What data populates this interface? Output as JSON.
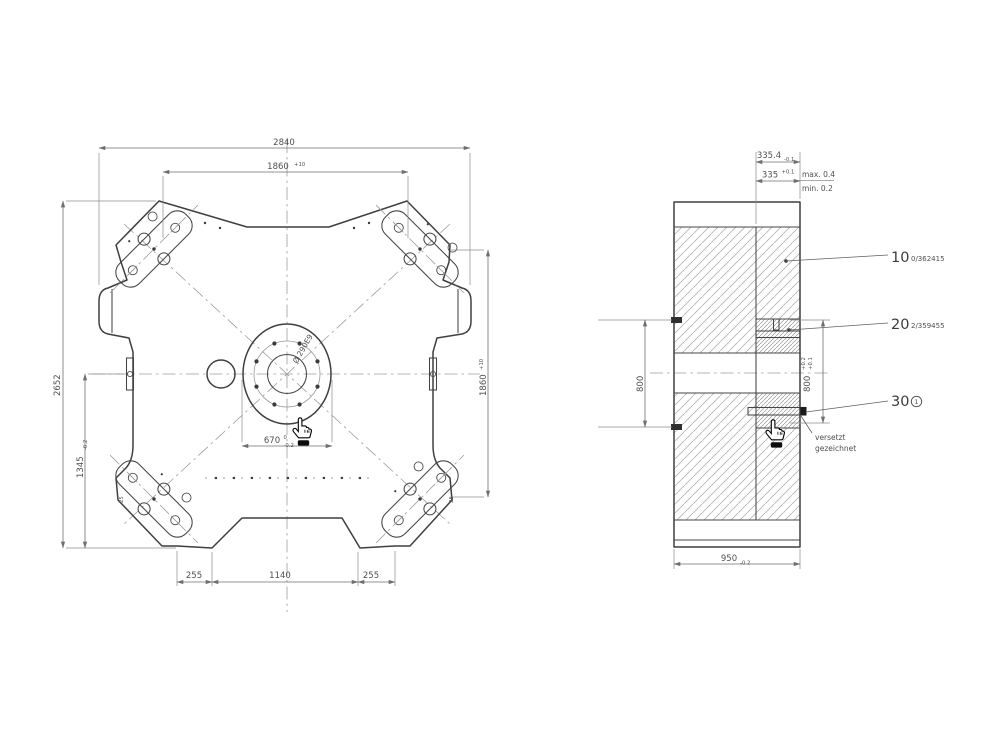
{
  "title": "assembly-drawing",
  "colors": {
    "background": "#ffffff",
    "outline": "#3f3f3f",
    "dimension": "#6f6f6f",
    "hatch": "#b5b5b5",
    "cursor_cuff": "#111111"
  },
  "left_view": {
    "w_total": "2840",
    "w_inner": "1860",
    "w_inner_tol": "+10",
    "h_total": "2652",
    "h_lower": "1345",
    "h_lower_tol": "-0.2",
    "h_right": "1860",
    "h_right_tol": "+10",
    "bore": "Ø 290E9",
    "circle_dia": "670",
    "circle_tol_top": "0",
    "circle_tol_bot": "-0.2",
    "b_left": "255",
    "b_center": "1140",
    "b_right": "255",
    "note_a": "25",
    "note_b": "25"
  },
  "right_view": {
    "step_outer": "335.4",
    "step_outer_tol": "-0.1",
    "step_inner": "335",
    "step_inner_tol": "+0.1",
    "gap_max": "max. 0.4",
    "gap_min": "min. 0.2",
    "pin_spacing": "800",
    "slot_spacing": "800",
    "slot_tol_top": "+0.2",
    "slot_tol_bot": "+0.1",
    "width": "950",
    "width_tol": "-0.2",
    "offset_note_1": "versetzt",
    "offset_note_2": "gezeichnet",
    "parts": [
      {
        "num": "10",
        "ref": "0/362415"
      },
      {
        "num": "20",
        "ref": "2/359455"
      },
      {
        "num": "30",
        "ref": "1"
      }
    ]
  }
}
